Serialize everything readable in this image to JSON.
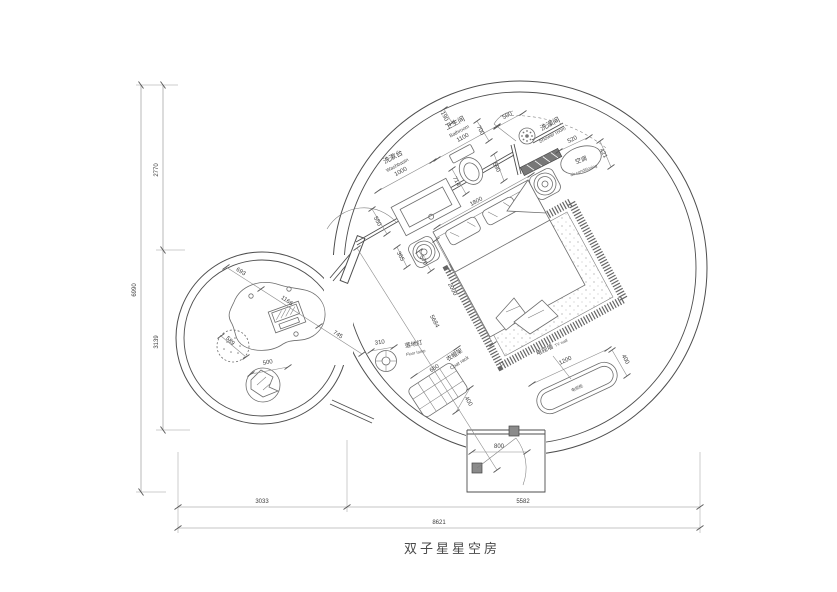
{
  "title": "双子星星空房",
  "labels": {
    "washbasin_cn": "洗漱台",
    "washbasin_en": "Washbasin",
    "bathroom_cn": "卫生间",
    "bathroom_en": "Bathroom",
    "shower_cn": "洗澡间",
    "shower_en": "Shower room",
    "ac_cn": "空调",
    "ac_en": "air conditioning",
    "floor_lamp_cn": "落地灯",
    "floor_lamp_en": "Floor lamp",
    "coat_rack_cn": "衣帽架",
    "coat_rack_en": "Coat rack",
    "tv_wall_cn": "电视墙",
    "tv_wall_en": "TV wall",
    "tv_cabinet_cn": "电视柜"
  },
  "dims": {
    "overall_width": "8621",
    "lounge_width": "3033",
    "bedroom_width": "5582",
    "overall_height": "6990",
    "upper_height": "2770",
    "lower_height": "3139",
    "washbasin_width": "1000",
    "counter_depth": "550",
    "bathroom_width": "1100",
    "wall_niche": "190",
    "door_opening": "700",
    "shower_door": "500",
    "partition": "590",
    "shower_width": "520",
    "ac_depth": "421",
    "toilet": "714",
    "bed_width": "1800",
    "bed_length": "2000",
    "nightstand_offset": "365",
    "nightstand_width": "570",
    "room_diagonal": "5684",
    "lamp_dia": "310",
    "coat_rack_width": "660",
    "coat_rack_depth": "400",
    "tv_width": "1200",
    "tv_depth": "400",
    "entry_door": "800",
    "lounge_seg_a": "693",
    "table_width": "1166",
    "lounge_seg_b": "745",
    "pouf_dia": "589",
    "chair_dia": "500"
  }
}
